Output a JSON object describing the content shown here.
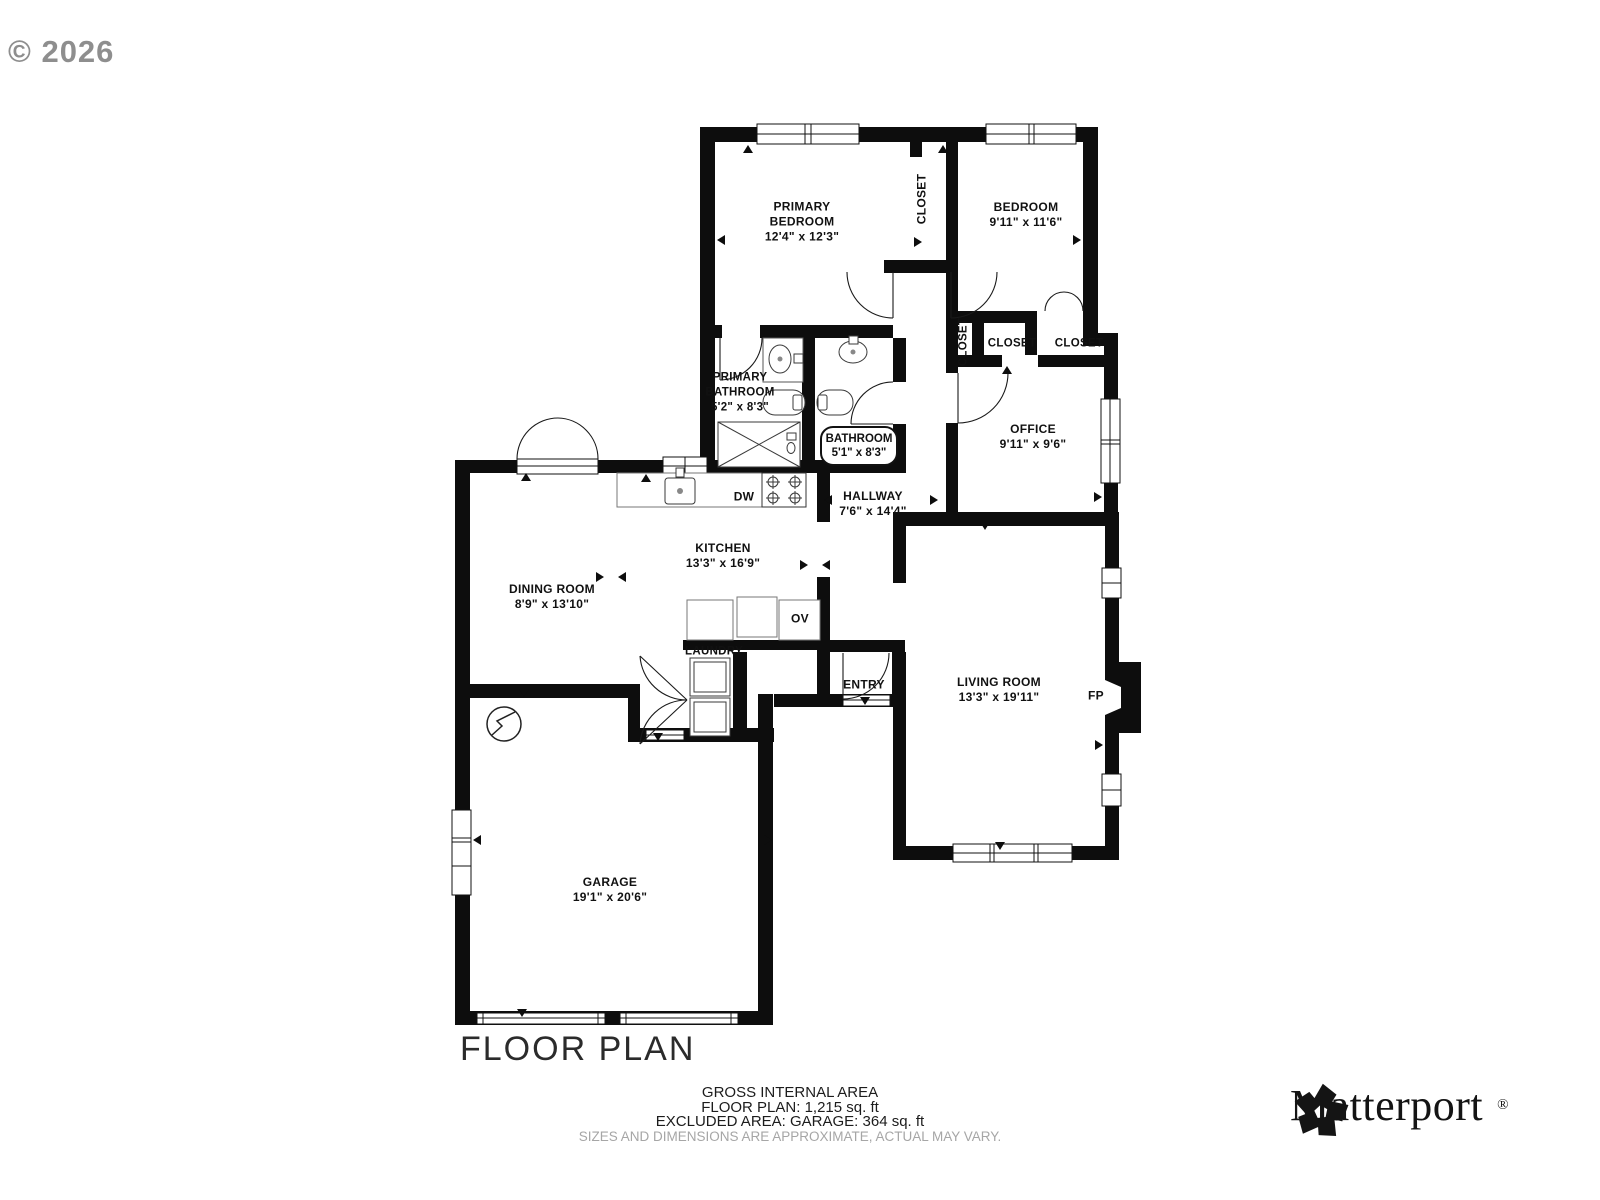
{
  "watermark": "© 2026",
  "title": "FLOOR PLAN",
  "rooms": {
    "primary_bedroom": {
      "text": "PRIMARY\nBEDROOM\n12'4\" x 12'3\""
    },
    "bedroom": {
      "text": "BEDROOM\n9'11\" x 11'6\""
    },
    "closet_primary": {
      "text": "CLOSET"
    },
    "closet_hall": {
      "text": "CLOSET"
    },
    "closet_mid": {
      "text": "CLOSET"
    },
    "closet_right": {
      "text": "CLOSET"
    },
    "primary_bathroom": {
      "text": "PRIMARY\nBATHROOM\n5'2\" x 8'3\""
    },
    "bathroom": {
      "text": "BATHROOM\n5'1\" x 8'3\""
    },
    "office": {
      "text": "OFFICE\n9'11\" x 9'6\""
    },
    "hallway": {
      "text": "HALLWAY\n7'6\" x 14'4\""
    },
    "kitchen": {
      "text": "KITCHEN\n13'3\" x 16'9\""
    },
    "dining_room": {
      "text": "DINING ROOM\n8'9\" x 13'10\""
    },
    "living_room": {
      "text": "LIVING ROOM\n13'3\" x 19'11\""
    },
    "garage": {
      "text": "GARAGE\n19'1\" x 20'6\""
    },
    "laundry": {
      "text": "LAUNDRY"
    },
    "entry": {
      "text": "ENTRY"
    }
  },
  "appliances": {
    "dishwasher": "DW",
    "oven": "OV",
    "fireplace": "FP"
  },
  "area_summary": {
    "heading": "GROSS INTERNAL AREA",
    "floor_plan": "FLOOR PLAN: 1,215 sq. ft",
    "excluded": "EXCLUDED AREA: GARAGE: 364 sq. ft",
    "disclaimer": "SIZES AND DIMENSIONS ARE APPROXIMATE, ACTUAL MAY VARY."
  },
  "brand": {
    "name": "Matterport",
    "registered_mark": "®"
  }
}
